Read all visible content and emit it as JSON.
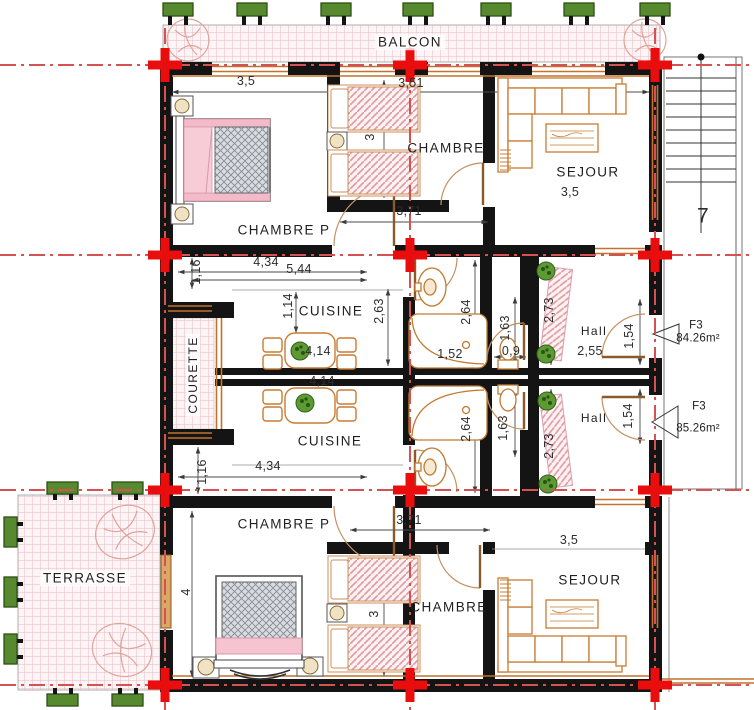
{
  "rooms": {
    "balcon": "BALCON",
    "chambre_p_upper": "CHAMBRE P",
    "chambre_upper": "CHAMBRE",
    "sejour_upper": "SEJOUR",
    "cuisine_upper": "CUISINE",
    "courette": "COURETTE",
    "hall_upper": "Hall",
    "cuisine_lower": "CUISINE",
    "chambre_p_lower": "CHAMBRE P",
    "chambre_lower": "CHAMBRE",
    "sejour_lower": "SEJOUR",
    "hall_lower": "Hall",
    "terrasse": "TERRASSE"
  },
  "dims": {
    "balcony_left": "3,5",
    "balcony_mid": "3,51",
    "sejour_upper_w": "3,5",
    "chambre_upper_w": "3",
    "corridor_upper": "3,71",
    "kitchen_upper_w": "4,34",
    "kitchen_upper_diag": "5,44",
    "courette_top": "1,16",
    "kitchen_top_offset": "1,14",
    "kitchen_upper_h": "2,63",
    "bath_upper_h": "2,64",
    "bath_upper_w": "1,52",
    "table_upper": "4,14",
    "table_lower": "4,14",
    "wc_upper_h": "1,63",
    "wc_door_w": "0,9",
    "loggia_upper_h": "2,73",
    "hall_upper_w": "2,55",
    "hall_upper_h": "1,54",
    "wc_lower_h": "1,63",
    "bath_lower_h": "2,64",
    "loggia_lower_h": "2,73",
    "hall_lower_h": "1,54",
    "kitchen_lower_w": "4,34",
    "courette_bottom": "1,16",
    "corridor_lower": "3,71",
    "terrasse_side": "4",
    "sejour_lower_w": "3,5",
    "chambre_lower_w": "3"
  },
  "markers": {
    "f3_upper": {
      "code": "F3",
      "area": "84.26m²"
    },
    "f3_lower": {
      "code": "F3",
      "area": "85.26m²"
    },
    "stair_direction": "7"
  },
  "colors": {
    "wall": "#141414",
    "grid_red": "#d65151",
    "cross_red": "#ea0d0d",
    "window_orange": "#c2722e",
    "furniture_orange": "#c97c33",
    "hatch_pink": "#e7bcc6",
    "plant_green": "#578a2e"
  }
}
